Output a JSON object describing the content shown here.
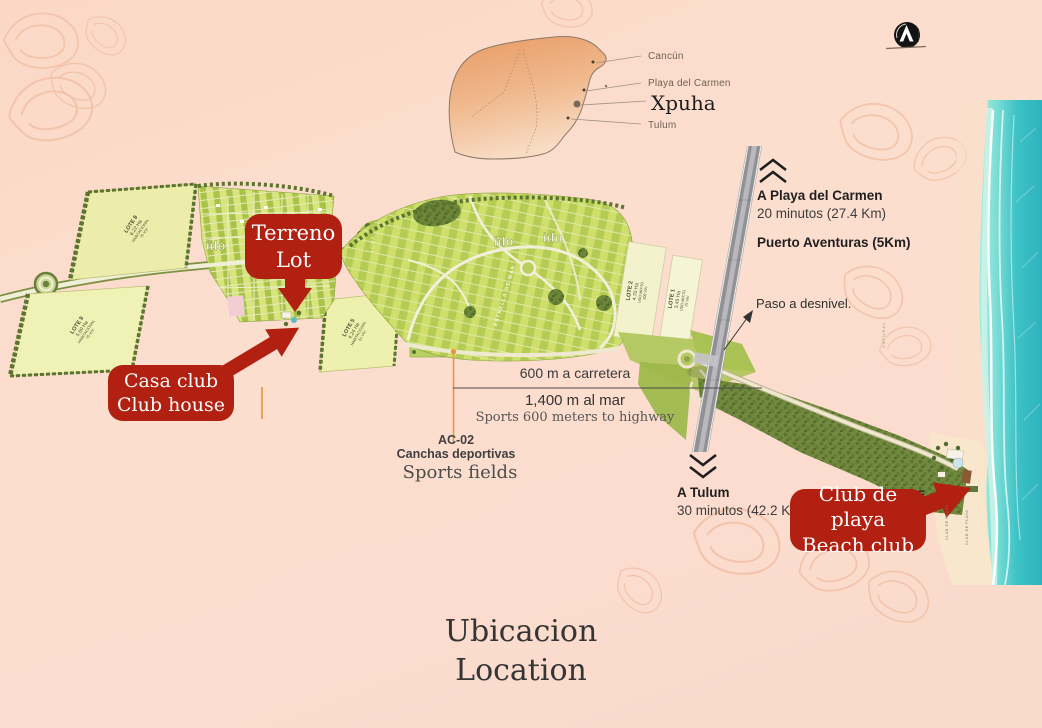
{
  "inset": {
    "cancun": "Cancún",
    "playa": "Playa del Carmen",
    "xpuha": "Xpuha",
    "tulum": "Tulum"
  },
  "north": {
    "title": "A Playa del Carmen",
    "time": "20 minutos (27.4 Km)",
    "puerto": "Puerto Aventuras (5Km)"
  },
  "paso": "Paso a desnivel.",
  "south": {
    "title": "A Tulum",
    "time": "30 minutos (42.2 Km)"
  },
  "distances": {
    "highway": "600 m a carretera",
    "sea": "1,400 m al mar",
    "note": "Sports 600 meters to highway"
  },
  "sports": {
    "code": "AC-02",
    "es": "Canchas deportivas",
    "en": "Sports fields"
  },
  "callouts": {
    "lot": {
      "l1": "Terreno",
      "l2": "Lot"
    },
    "club": {
      "l1": "Casa club",
      "l2": "Club house"
    },
    "beach": {
      "l1": "Club de playa",
      "l2": "Beach club"
    }
  },
  "lots": {
    "lote8": {
      "l1": "LOTE 8",
      "l2": "6.22 Ha",
      "l3": "HABITACIONAL",
      "l4": "75 VIV"
    },
    "lote9": {
      "l1": "LOTE 9",
      "l2": "5.60 Ha",
      "l3": "HABITACIONAL",
      "l4": "75 VIV"
    },
    "lote5": {
      "l1": "LOTE 5",
      "l2": "4.24 Ha",
      "l3": "HABITACIONAL",
      "l4": "51 VIV"
    },
    "lote2": {
      "l1": "LOTE 2",
      "l2": "4.70 Ha",
      "l3": "USO MIXTO",
      "l4": "200 VIV"
    },
    "lote1": {
      "l1": "LOTE 1",
      "l2": "3.45 Ha",
      "l3": "USO MIXTO",
      "l4": "75 VIV"
    }
  },
  "roads": {
    "estrella": "ESTRELLA DE MAR",
    "loma": "LOMA"
  },
  "beach": {
    "club1": "CLUB DE PLAYA",
    "club2": "CLUB DE PLAYA",
    "f": "F"
  },
  "misc": {
    "natural": "NATURAL",
    "watermark": "ido"
  },
  "title": {
    "es": "Ubicacion",
    "en": "Location"
  },
  "colors": {
    "accent_red": "#b22012",
    "marker_orange": "#e8963f",
    "ocean_teal": "#3cc2c6",
    "map_green": "#bfd453",
    "highway_gray": "#909095",
    "background_peach": "#fcdccb"
  }
}
